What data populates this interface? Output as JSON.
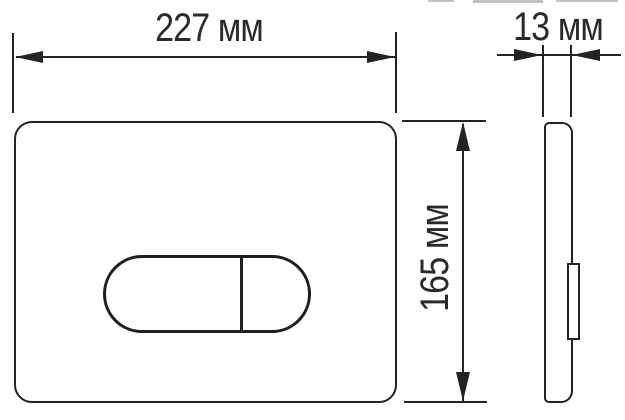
{
  "diagram": {
    "type": "technical-dimension-drawing",
    "subject": "toilet flush plate with oval dual-flush button, front and side views",
    "dimensions": {
      "width": {
        "label": "227 мм",
        "value": 227,
        "unit": "мм"
      },
      "height": {
        "label": "165 мм",
        "value": 165,
        "unit": "мм"
      },
      "depth": {
        "label": "13 мм",
        "value": 13,
        "unit": "мм"
      }
    },
    "colors": {
      "line": "#232323",
      "text": "#2a2a2a",
      "background": "#fefefe"
    }
  }
}
